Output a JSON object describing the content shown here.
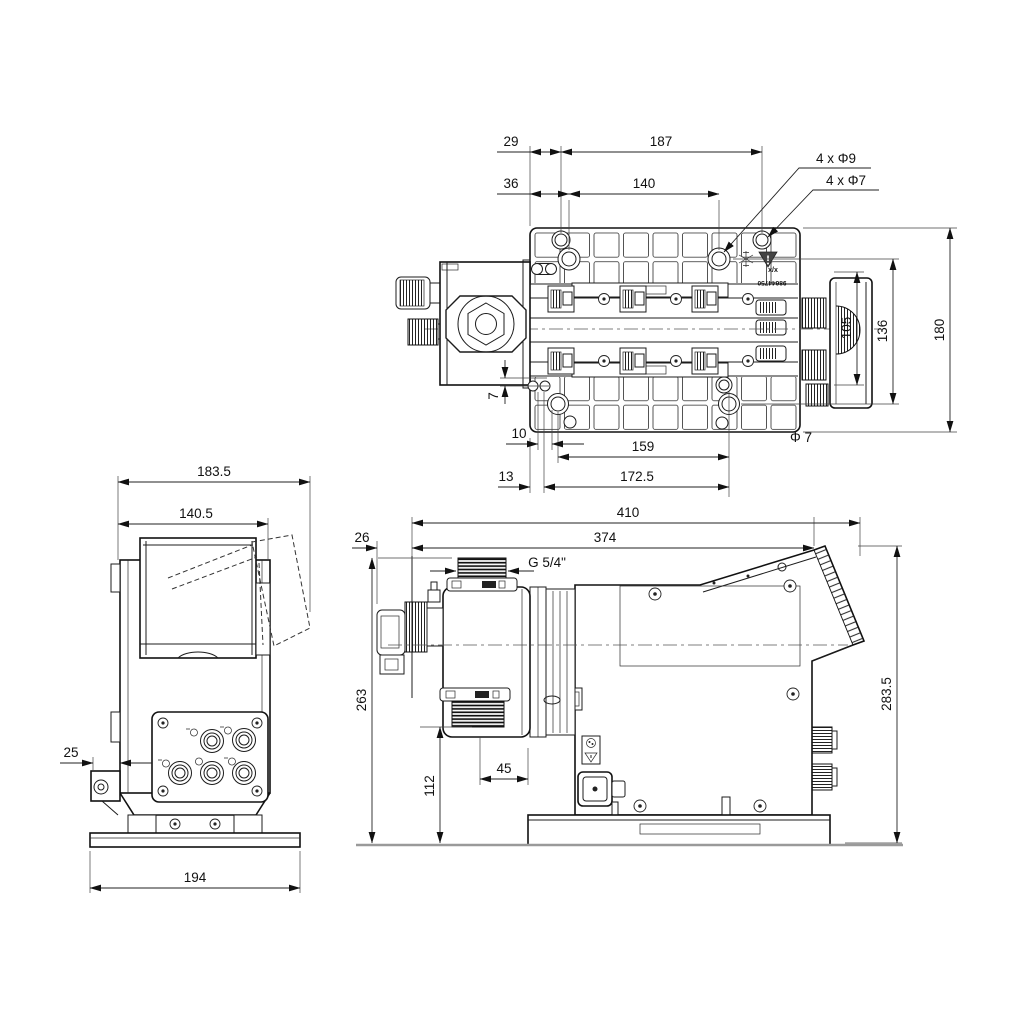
{
  "meta": {
    "background": "#ffffff",
    "line_color": "#1c1c1c",
    "ground_color": "#9a9a9a"
  },
  "top_view": {
    "d29": "29",
    "d187": "187",
    "d36": "36",
    "d140": "140",
    "holes_label_1": "4 x Φ9",
    "holes_label_2": "4 x Φ7",
    "d105": "105",
    "d136": "136",
    "d180": "180",
    "d7": "7",
    "d10": "10",
    "d159": "159",
    "dia7": "Φ 7",
    "d13": "13",
    "d172_5": "172.5",
    "plate_marking_top": "x/x",
    "plate_marking_number": "98644750"
  },
  "front_view": {
    "d183_5": "183.5",
    "d140_5": "140.5",
    "d25": "25",
    "d194": "194"
  },
  "side_view": {
    "d410": "410",
    "d374": "374",
    "d26": "26",
    "thread_label": "G 5/4\"",
    "d263": "263",
    "d112": "112",
    "d45": "45",
    "d283_5": "283.5"
  }
}
